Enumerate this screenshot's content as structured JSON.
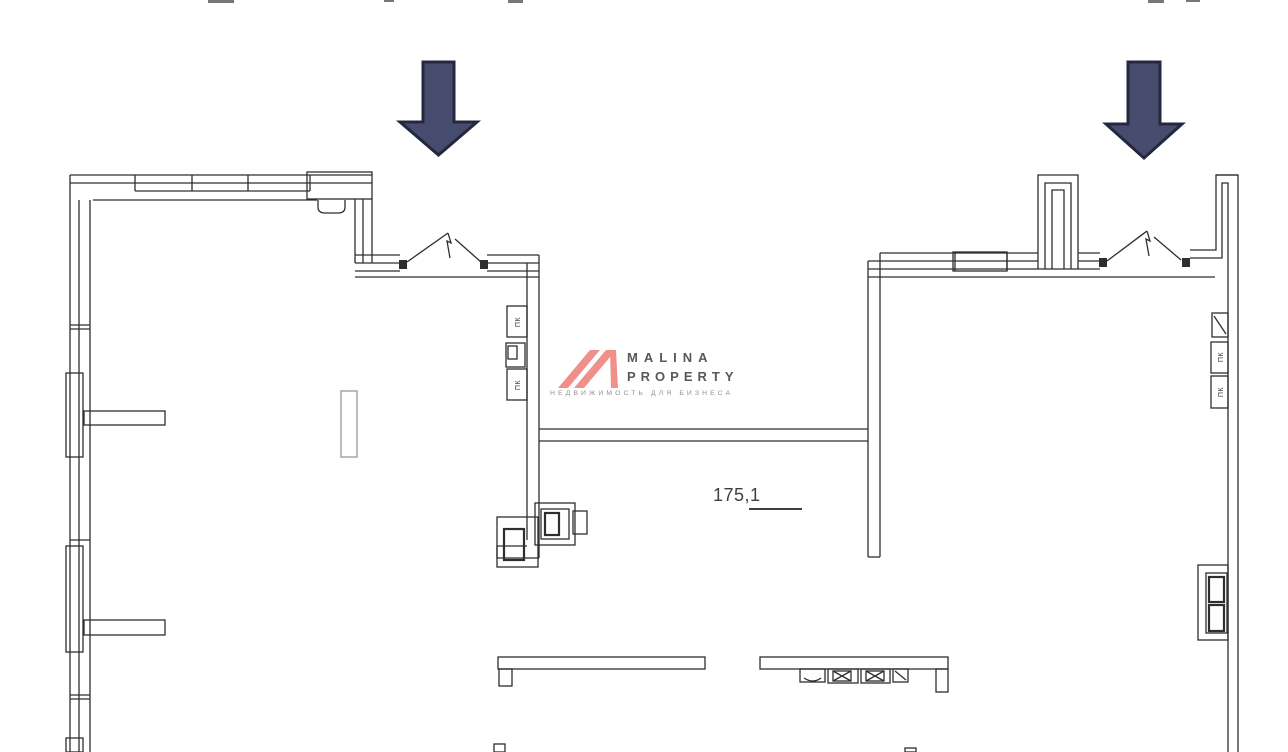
{
  "branding": {
    "name_line1": "MALINA",
    "name_line2": "PROPERTY",
    "tagline": "НЕДВИЖИМОСТЬ ДЛЯ БИЗНЕСА"
  },
  "plan": {
    "area_label": "175,1",
    "fire_cabinet_label": "ПК"
  },
  "colors": {
    "bg": "#ffffff",
    "wall": "#2e2e30",
    "wall-light": "#a0a0a2",
    "arrow-fill": "#474c6e",
    "arrow-outline": "#23273f",
    "brand": "#f0908a",
    "brand-text": "#58585a",
    "brand-tagline": "#8f8f92",
    "label": "#3f3f41"
  }
}
